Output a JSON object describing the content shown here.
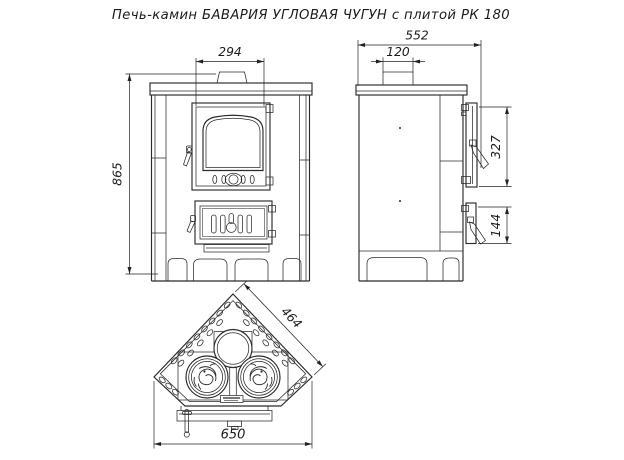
{
  "title": "Печь-камин БАВАРИЯ УГЛОВАЯ ЧУГУН с плитой РК 180",
  "drawing": {
    "front_view": {
      "width_mm": "294",
      "height_mm": "865"
    },
    "side_view": {
      "depth_mm": "552",
      "flue_mm": "120",
      "upper_door_mm": "327",
      "lower_door_mm": "144"
    },
    "top_view": {
      "side_mm": "464",
      "width_mm": "650"
    }
  },
  "colors": {
    "line": "#2b2b2b",
    "dim": "#1f1f1f",
    "background": "#ffffff"
  }
}
